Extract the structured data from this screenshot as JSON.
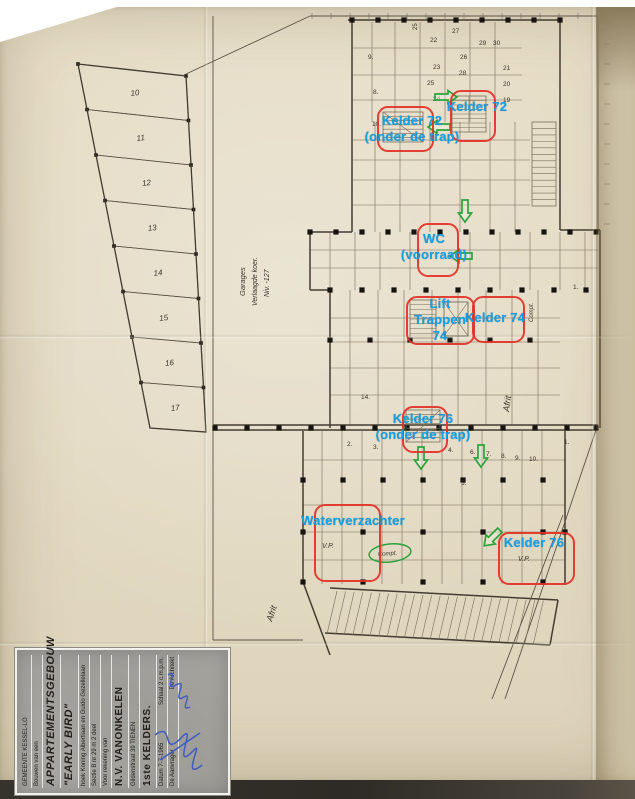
{
  "document": {
    "type_label": "scanned cellar floor plan with markup annotations",
    "accent_colors": {
      "annotation_text": "#149fe3",
      "highlight_box": "#e23127",
      "arrow": "#2ca33c"
    }
  },
  "annotations": {
    "labels": [
      {
        "id": "kelder-72-onder-de-trap",
        "lines": [
          "Kelder 72",
          "(onder de trap)"
        ],
        "cx": 412,
        "top": 113
      },
      {
        "id": "kelder-72",
        "lines": [
          "Kelder 72"
        ],
        "cx": 477,
        "top": 99
      },
      {
        "id": "wc-voorraad",
        "lines": [
          "WC",
          "(voorraad)"
        ],
        "cx": 434,
        "top": 231
      },
      {
        "id": "lift-trappen-74",
        "lines": [
          "Lift",
          "Trappen",
          "74"
        ],
        "cx": 440,
        "top": 296
      },
      {
        "id": "kelder-74",
        "lines": [
          "Kelder 74"
        ],
        "cx": 495,
        "top": 310
      },
      {
        "id": "kelder-76-onder-de-trap",
        "lines": [
          "Kelder 76",
          "(onder de trap)"
        ],
        "cx": 423,
        "top": 411
      },
      {
        "id": "waterverzachter",
        "lines": [
          "Waterverzachter"
        ],
        "cx": 353,
        "top": 513
      },
      {
        "id": "kelder-76",
        "lines": [
          "Kelder 76"
        ],
        "cx": 534,
        "top": 535
      }
    ],
    "boxes": [
      {
        "id": "box-kelder-72-trap",
        "x": 377,
        "y": 106,
        "w": 53,
        "h": 42
      },
      {
        "id": "box-kelder-72",
        "x": 450,
        "y": 90,
        "w": 42,
        "h": 48
      },
      {
        "id": "box-wc",
        "x": 417,
        "y": 223,
        "w": 38,
        "h": 50
      },
      {
        "id": "box-lift-trappen",
        "x": 406,
        "y": 296,
        "w": 65,
        "h": 45
      },
      {
        "id": "box-kelder-74",
        "x": 472,
        "y": 296,
        "w": 49,
        "h": 43
      },
      {
        "id": "box-kelder-76-trap",
        "x": 402,
        "y": 406,
        "w": 42,
        "h": 43
      },
      {
        "id": "box-waterverzachter",
        "x": 314,
        "y": 504,
        "w": 63,
        "h": 74
      },
      {
        "id": "box-kelder-76",
        "x": 498,
        "y": 532,
        "w": 73,
        "h": 49
      }
    ],
    "arrows": [
      {
        "cx": 446,
        "cy": 97,
        "dir": "right"
      },
      {
        "cx": 439,
        "cy": 127,
        "dir": "left"
      },
      {
        "cx": 465,
        "cy": 211,
        "dir": "down"
      },
      {
        "cx": 461,
        "cy": 256,
        "dir": "left"
      },
      {
        "cx": 421,
        "cy": 458,
        "dir": "down"
      },
      {
        "cx": 481,
        "cy": 456,
        "dir": "down"
      },
      {
        "cx": 492,
        "cy": 538,
        "dir": "down-left"
      }
    ],
    "circle": {
      "cx": 390,
      "cy": 553,
      "rx": 21,
      "ry": 9
    }
  },
  "plan": {
    "garage_numbers": [
      "10",
      "11",
      "12",
      "13",
      "14",
      "15",
      "16",
      "17"
    ],
    "texts": [
      {
        "t": "9.",
        "x": 368,
        "y": 59
      },
      {
        "t": "8.",
        "x": 373,
        "y": 94
      },
      {
        "t": "10.",
        "x": 372,
        "y": 126
      },
      {
        "t": "22",
        "x": 430,
        "y": 42
      },
      {
        "t": "27",
        "x": 452,
        "y": 33
      },
      {
        "t": "29",
        "x": 479,
        "y": 45
      },
      {
        "t": "30",
        "x": 493,
        "y": 45
      },
      {
        "t": "26",
        "x": 460,
        "y": 59
      },
      {
        "t": "23",
        "x": 433,
        "y": 69
      },
      {
        "t": "28",
        "x": 459,
        "y": 75
      },
      {
        "t": "25",
        "x": 427,
        "y": 85
      },
      {
        "t": "24",
        "x": 433,
        "y": 101
      },
      {
        "t": "21",
        "x": 503,
        "y": 70
      },
      {
        "t": "20",
        "x": 503,
        "y": 86
      },
      {
        "t": "19",
        "x": 503,
        "y": 102
      },
      {
        "t": "14.",
        "x": 361,
        "y": 399
      },
      {
        "t": "2.",
        "x": 347,
        "y": 446
      },
      {
        "t": "3.",
        "x": 373,
        "y": 449
      },
      {
        "t": "4.",
        "x": 448,
        "y": 452
      },
      {
        "t": "6.",
        "x": 470,
        "y": 454
      },
      {
        "t": "7.",
        "x": 486,
        "y": 456
      },
      {
        "t": "8.",
        "x": 501,
        "y": 458
      },
      {
        "t": "9.",
        "x": 515,
        "y": 460
      },
      {
        "t": "10.",
        "x": 529,
        "y": 461
      },
      {
        "t": "5.",
        "x": 461,
        "y": 485
      },
      {
        "t": "1.",
        "x": 564,
        "y": 444
      },
      {
        "t": "1.",
        "x": 573,
        "y": 289
      },
      {
        "t": "25",
        "x": 417,
        "y": 30,
        "rot": -90,
        "s": 6
      },
      {
        "t": "Garages",
        "x": 245,
        "y": 296,
        "rot": -90,
        "s": 7.5,
        "it": 1
      },
      {
        "t": "Verlaagde koer.",
        "x": 257,
        "y": 306,
        "rot": -90,
        "s": 7,
        "it": 1
      },
      {
        "t": "Niv. -127",
        "x": 269,
        "y": 297,
        "rot": -90,
        "s": 7,
        "it": 1
      },
      {
        "t": "Afrit",
        "x": 509,
        "y": 412,
        "rot": -82,
        "s": 9,
        "it": 1
      },
      {
        "t": "Afrit",
        "x": 272,
        "y": 622,
        "rot": -72,
        "s": 9,
        "it": 1
      },
      {
        "t": "Compt.",
        "x": 378,
        "y": 556,
        "rot": -4,
        "s": 6,
        "it": 1
      },
      {
        "t": "Compt.",
        "x": 533,
        "y": 322,
        "rot": -90,
        "s": 6,
        "it": 1
      },
      {
        "t": "V.P.",
        "x": 322,
        "y": 548,
        "s": 7,
        "it": 1
      },
      {
        "t": "V.P.",
        "x": 518,
        "y": 561,
        "s": 7,
        "it": 1
      }
    ]
  },
  "title_block": {
    "rows": [
      {
        "cells": [
          "GEMEENTE KESSEL-LO"
        ],
        "cls": "tiny"
      },
      {
        "cells": [
          "Bouwen van een"
        ],
        "cls": "tiny"
      },
      {
        "cells": [
          "APPARTEMENTSGEBOUW"
        ],
        "cls": "big"
      },
      {
        "cells": [
          "\"EARLY BIRD\""
        ],
        "cls": "big"
      },
      {
        "cells": [
          "hoek Koning Albertlaan en Guido Gezellelaan"
        ],
        "cls": "tiny"
      },
      {
        "cells": [
          "Sectie B nr 29 m 2 deel"
        ],
        "cls": "tiny"
      },
      {
        "cells": [
          "Voor rekening van"
        ],
        "cls": "tiny"
      },
      {
        "cells": [
          "N.V. VANONKELEN"
        ],
        "cls": "med"
      },
      {
        "cells": [
          "Gildenstraat 39 TIENEN"
        ],
        "cls": "tiny"
      },
      {
        "cells": [
          "1ste KELDERS."
        ],
        "cls": "med"
      },
      {
        "cells": [
          "Datum  7-7-1965",
          "Schaal  2 c.m.p.m."
        ],
        "cls": "tiny"
      },
      {
        "cells": [
          "De Aanvrager",
          "De Architekt"
        ],
        "cls": "tiny"
      }
    ]
  }
}
